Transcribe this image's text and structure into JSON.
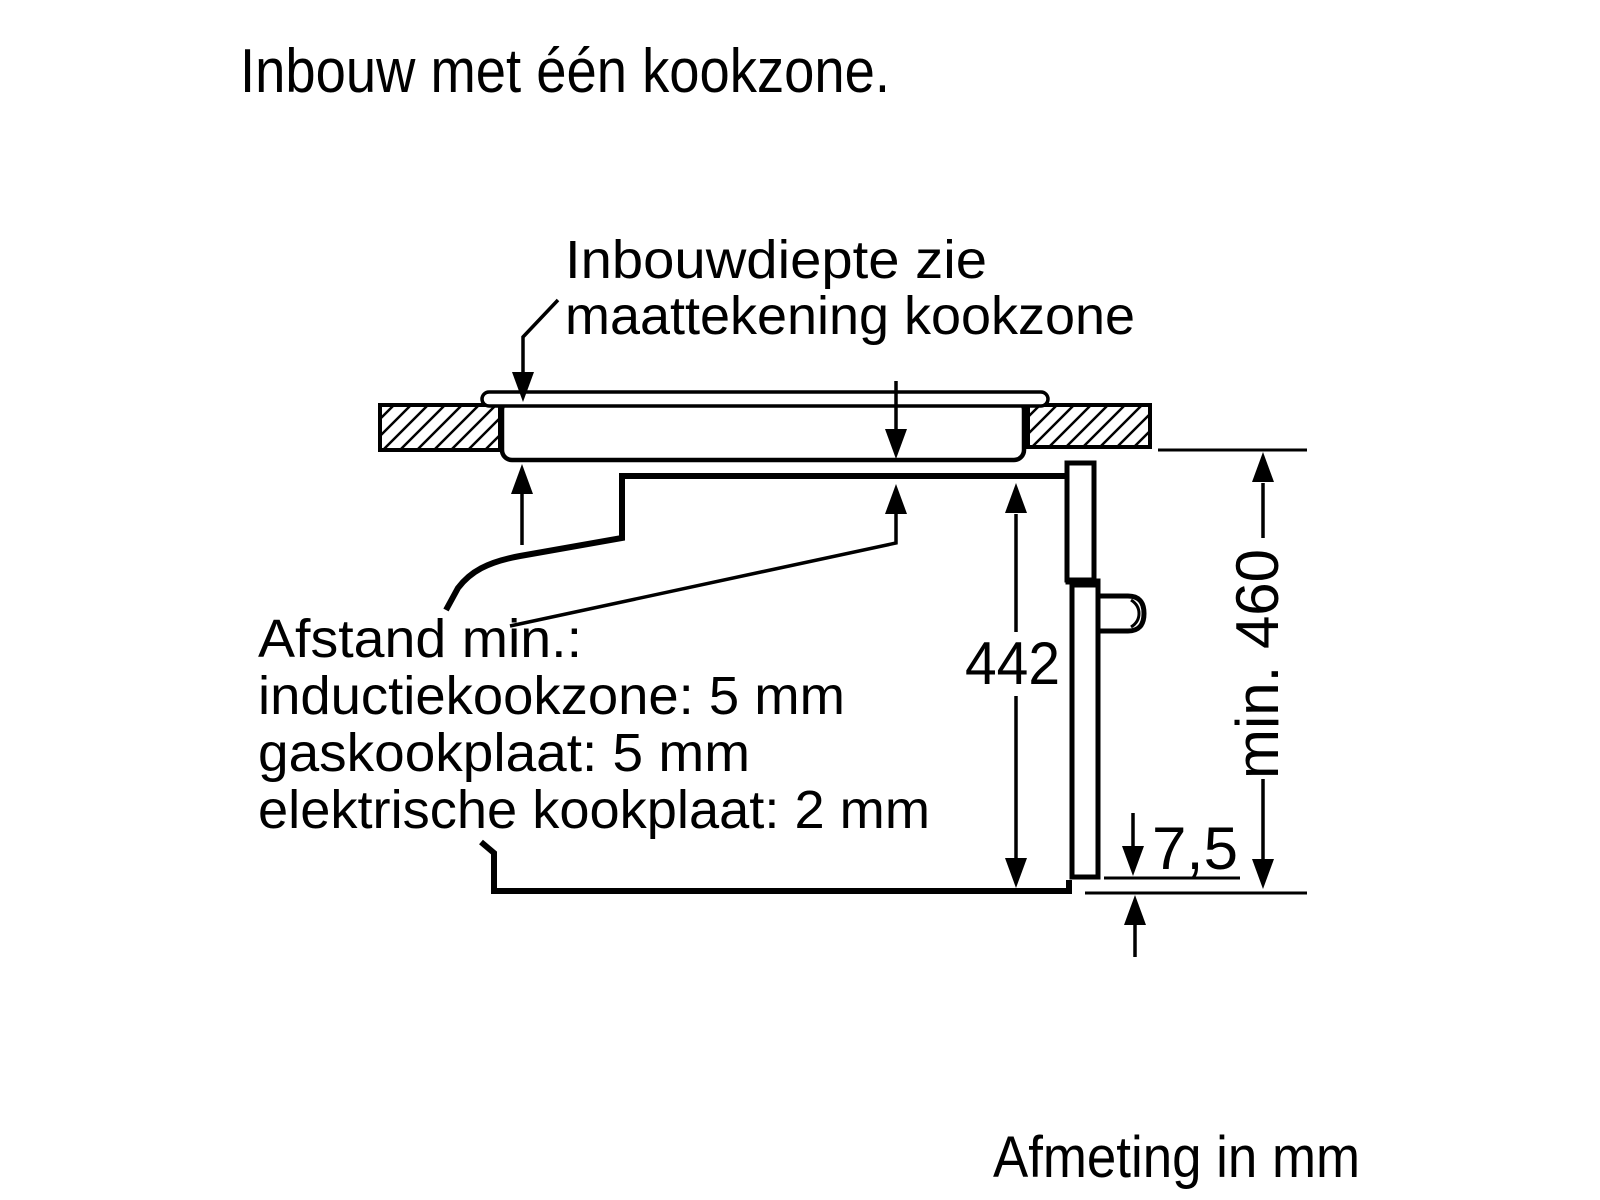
{
  "title": "Inbouw met één kookzone.",
  "diagram": {
    "note_line1": "Inbouwdiepte zie",
    "note_line2": "maattekening kookzone",
    "distance_note": {
      "line1": "Afstand min.:",
      "line2": "inductiekookzone: 5 mm",
      "line3": "gaskookplaat: 5 mm",
      "line4": "elektrische kookplaat: 2 mm"
    },
    "dimensions": {
      "oven_height": "442",
      "niche_height": "min. 460",
      "bottom_gap": "7,5"
    },
    "footer": "Afmeting in mm",
    "colors": {
      "line": "#000000",
      "background": "#ffffff"
    }
  }
}
